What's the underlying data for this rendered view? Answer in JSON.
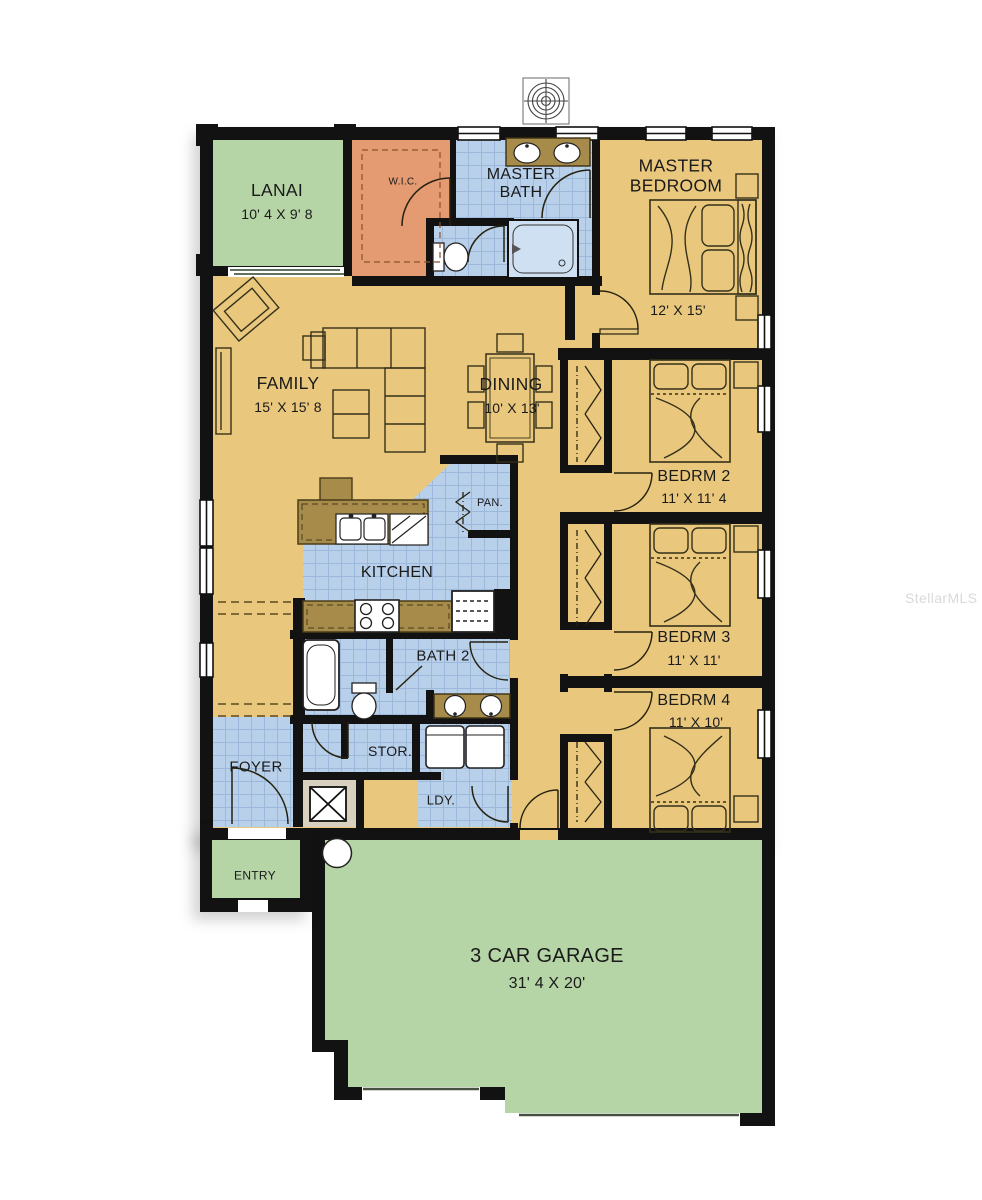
{
  "watermark": "StellarMLS",
  "colors": {
    "floor_gold": "#e9c87d",
    "porch_green": "#b6d5a7",
    "tile_blue": "#b9d0ea",
    "tile_line": "#9cb8da",
    "wic_orange": "#e49b72",
    "counter_brown": "#a68b4b",
    "pad_beige": "#d9d1c0",
    "wall_black": "#121212",
    "furniture_line": "#35301a",
    "label_ink": "#1a1a1a",
    "watermark_gray": "#d9d9d9"
  },
  "rooms": {
    "lanai": {
      "label": "LANAI",
      "dims": "10' 4 X 9' 8"
    },
    "wic": {
      "label": "W.I.C."
    },
    "master_bath": {
      "label_line1": "MASTER",
      "label_line2": "BATH"
    },
    "master_bedroom": {
      "label_line1": "MASTER",
      "label_line2": "BEDROOM",
      "dims": "12' X 15'"
    },
    "family": {
      "label": "FAMILY",
      "dims": "15' X 15' 8"
    },
    "dining": {
      "label": "DINING",
      "dims": "10' X 13'"
    },
    "bedroom2": {
      "label": "BEDRM 2",
      "dims": "11' X 11' 4"
    },
    "bedroom3": {
      "label": "BEDRM 3",
      "dims": "11' X 11'"
    },
    "bedroom4": {
      "label": "BEDRM 4",
      "dims": "11' X 10'"
    },
    "kitchen": {
      "label": "KITCHEN"
    },
    "pantry": {
      "label": "PAN."
    },
    "bath2": {
      "label": "BATH 2"
    },
    "foyer": {
      "label": "FOYER"
    },
    "storage": {
      "label": "STOR."
    },
    "laundry": {
      "label": "LDY."
    },
    "entry": {
      "label": "ENTRY"
    },
    "garage": {
      "label": "3 CAR GARAGE",
      "dims": "31' 4 X 20'"
    }
  }
}
